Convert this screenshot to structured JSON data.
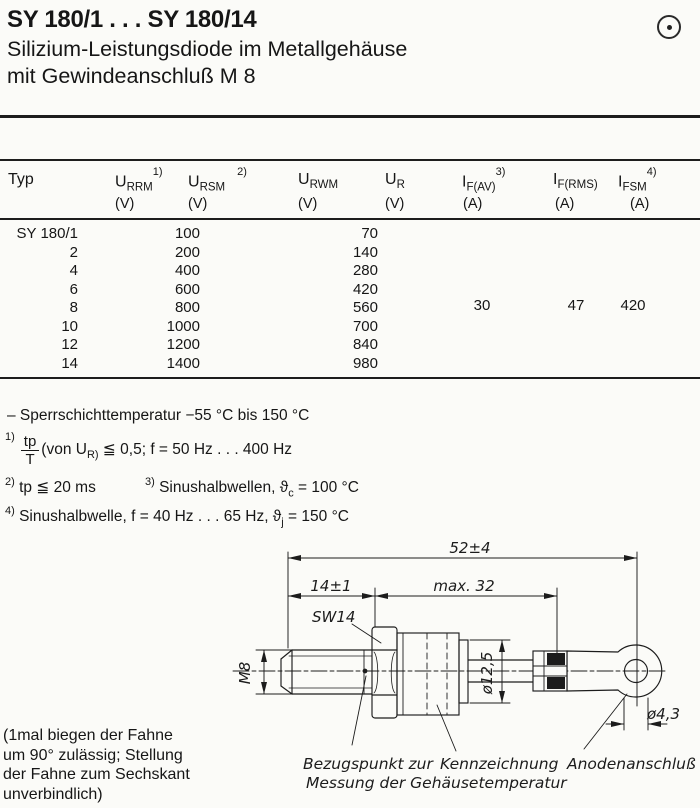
{
  "header": {
    "title": "SY 180/1 . . . SY 180/14",
    "subtitle_line1": "Silizium-Leistungsdiode im Metallgehäuse",
    "subtitle_line2": "mit Gewindeanschluß M 8"
  },
  "icons": {
    "top_right": "circled-dot"
  },
  "table": {
    "col_typ": "Typ",
    "headers": [
      {
        "main": "U",
        "sub": "RRM",
        "sup": "1)",
        "unit": "(V)"
      },
      {
        "main": "U",
        "sub": "RSM",
        "sup": "2)",
        "unit": "(V)"
      },
      {
        "main": "U",
        "sub": "RWM",
        "sup": "",
        "unit": "(V)"
      },
      {
        "main": "U",
        "sub": "R",
        "sup": "",
        "unit": "(V)"
      },
      {
        "main": "I",
        "sub": "F(AV)",
        "sup": "3)",
        "unit": "(A)"
      },
      {
        "main": "I",
        "sub": "F(RMS)",
        "sup": "",
        "unit": "(A)"
      },
      {
        "main": "I",
        "sub": "FSM",
        "sup": "4)",
        "unit": "(A)"
      }
    ],
    "rows": [
      {
        "typ": "SY 180/1",
        "v1": "100",
        "v2": "70"
      },
      {
        "typ": "2",
        "v1": "200",
        "v2": "140"
      },
      {
        "typ": "4",
        "v1": "400",
        "v2": "280"
      },
      {
        "typ": "6",
        "v1": "600",
        "v2": "420"
      },
      {
        "typ": "8",
        "v1": "800",
        "v2": "560"
      },
      {
        "typ": "10",
        "v1": "1000",
        "v2": "700"
      },
      {
        "typ": "12",
        "v1": "1200",
        "v2": "840"
      },
      {
        "typ": "14",
        "v1": "1400",
        "v2": "980"
      }
    ],
    "shared_ratings": {
      "if_av": "30",
      "if_rms": "47",
      "ifsm": "420"
    }
  },
  "notes": {
    "temp": "– Sperrschichttemperatur −55 °C bis 150 °C",
    "n1_mark": "1)",
    "n1_frac_num": "tp",
    "n1_frac_den": "T",
    "n1_text_a": "(von U",
    "n1_sub": "R)",
    "n1_text_b": " ≦ 0,5; f = 50 Hz . . . 400 Hz",
    "n2_mark": "2)",
    "n2_text": " tp ≦ 20 ms",
    "n3_mark": "3)",
    "n3_text_a": " Sinushalbwellen,  ϑ",
    "n3_sub": "c",
    "n3_text_b": " = 100 °C",
    "n4_mark": "4)",
    "n4_text_a": " Sinushalbwelle, f = 40 Hz . . . 65 Hz,  ϑ",
    "n4_sub": "j",
    "n4_text_b": " = 150 °C"
  },
  "drawing": {
    "dim_overall": "52±4",
    "dim_thread_len": "14±1",
    "dim_body_len": "max. 32",
    "dim_thread": "M8",
    "wrench_size": "SW14",
    "dim_body_dia": "ø12,5",
    "dim_hole_dia": "ø4,3",
    "label_ref_line1": "Bezugspunkt zur",
    "label_ref_line2": "Messung der Gehäusetemperatur",
    "label_marking": "Kennzeichnung",
    "label_anode": "Anodenanschluß"
  },
  "flag_note": {
    "line1": "(1mal biegen der Fahne",
    "line2": "um 90° zulässig; Stellung",
    "line3": "der Fahne zum Sechskant",
    "line4": "unverbindlich)"
  }
}
